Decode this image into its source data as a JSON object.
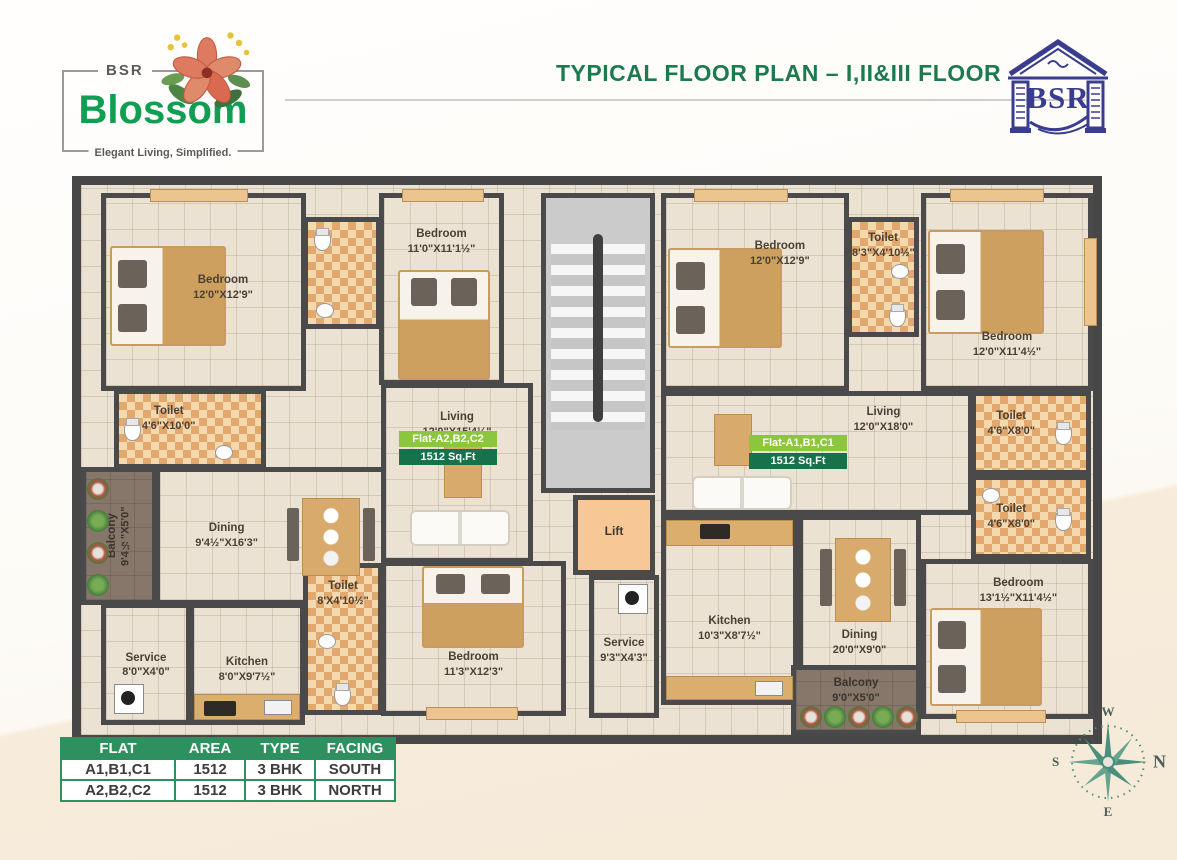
{
  "header": {
    "title": "TYPICAL FLOOR PLAN – I,II&III FLOOR"
  },
  "brand": {
    "top": "BSR",
    "name": "Blossom",
    "tagline": "Elegant Living, Simplified."
  },
  "logo_right": {
    "text": "BSR"
  },
  "flats": {
    "left": {
      "label": "Flat-A2,B2,C2",
      "area": "1512 Sq.Ft"
    },
    "right": {
      "label": "Flat-A1,B1,C1",
      "area": "1512 Sq.Ft"
    }
  },
  "rooms": {
    "l_bedroom1": {
      "name": "Bedroom",
      "dims": "12'0\"X12'9\""
    },
    "l_bedroom2": {
      "name": "Bedroom",
      "dims": "11'0\"X11'1½\""
    },
    "l_toilet1": {
      "name": "Toilet",
      "dims": "4'6\"X10'0\""
    },
    "l_balcony": {
      "name": "Balcony",
      "dims": "9'4½\"X5'0\""
    },
    "l_dining": {
      "name": "Dining",
      "dims": "9'4½\"X16'3\""
    },
    "l_living": {
      "name": "Living",
      "dims": "12'0\"X15'4½\""
    },
    "l_toilet2": {
      "name": "Toilet",
      "dims": "8'X4'10½\""
    },
    "l_bedroom3": {
      "name": "Bedroom",
      "dims": "11'3\"X12'3\""
    },
    "l_service": {
      "name": "Service",
      "dims": "8'0\"X4'0\""
    },
    "l_kitchen": {
      "name": "Kitchen",
      "dims": "8'0\"X9'7½\""
    },
    "lift": {
      "name": "Lift"
    },
    "c_service": {
      "name": "Service",
      "dims": "9'3\"X4'3\""
    },
    "r_bedroom1": {
      "name": "Bedroom",
      "dims": "12'0\"X12'9\""
    },
    "r_toilet1": {
      "name": "Toilet",
      "dims": "8'3\"X4'10½\""
    },
    "r_bedroom2": {
      "name": "Bedroom",
      "dims": "12'0\"X11'4½\""
    },
    "r_toilet2": {
      "name": "Toilet",
      "dims": "4'6\"X8'0\""
    },
    "r_toilet3": {
      "name": "Toilet",
      "dims": "4'6\"X8'0\""
    },
    "r_living": {
      "name": "Living",
      "dims": "12'0\"X18'0\""
    },
    "r_kitchen": {
      "name": "Kitchen",
      "dims": "10'3\"X8'7½\""
    },
    "r_dining": {
      "name": "Dining",
      "dims": "20'0\"X9'0\""
    },
    "r_bedroom3": {
      "name": "Bedroom",
      "dims": "13'1½\"X11'4½\""
    },
    "r_balcony": {
      "name": "Balcony",
      "dims": "9'0\"X5'0\""
    }
  },
  "table": {
    "headers": [
      "FLAT",
      "AREA",
      "TYPE",
      "FACING"
    ],
    "rows": [
      [
        "A1,B1,C1",
        "1512",
        "3 BHK",
        "SOUTH"
      ],
      [
        "A2,B2,C2",
        "1512",
        "3 BHK",
        "NORTH"
      ]
    ]
  },
  "compass": {
    "top": "W",
    "right": "N",
    "left": "S",
    "bottom": "E"
  },
  "colors": {
    "title_green": "#1d7a4f",
    "brand_green": "#0f9e52",
    "logo_blue": "#3a3d8e",
    "table_header": "#2e8f5f",
    "flat_tag_light": "#8cc63e",
    "flat_tag_dark": "#17714a",
    "wall": "#474747",
    "toilet_checker": "#e3a86e",
    "lift_fill": "#f7c795"
  }
}
